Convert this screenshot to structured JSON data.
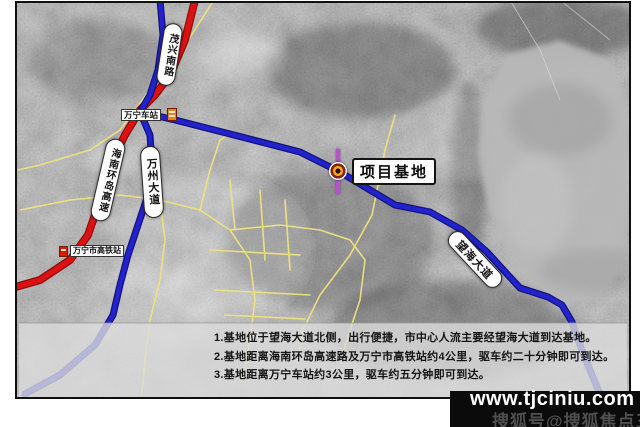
{
  "map": {
    "labels": {
      "maoxing_road": "茂兴南路",
      "huandao_expressway": "海南环岛高速",
      "wanzhou_avenue": "万州大道",
      "wanghai_avenue": "望海大道",
      "wanning_station": "万宁车站",
      "wanning_hsr_station": "万宁市高铁站",
      "project_base": "项目基地"
    },
    "info_box": {
      "lines": [
        "1.基地位于望海大道北侧，出行便捷，市中心人流主要经望海大道到达基地。",
        "2.基地距离海南环岛高速路及万宁市高铁站约4公里，驱车约二十分钟即可到达。",
        "3.基地距离万宁车站约3公里，驱车约五分钟即可到达。"
      ]
    },
    "colors": {
      "highway_red": "#dd1111",
      "road_blue": "#2323cd",
      "road_yellow": "#ece47e",
      "marker_purple": "#b553c8",
      "label_bg": "#ffffff",
      "info_box_bg": "#dcdcdc"
    }
  },
  "watermark": {
    "site_url": "www.tjciniu.com",
    "credit": "搜狐号@搜狐焦点三亚站",
    "band_color": "#0b0b0b"
  }
}
